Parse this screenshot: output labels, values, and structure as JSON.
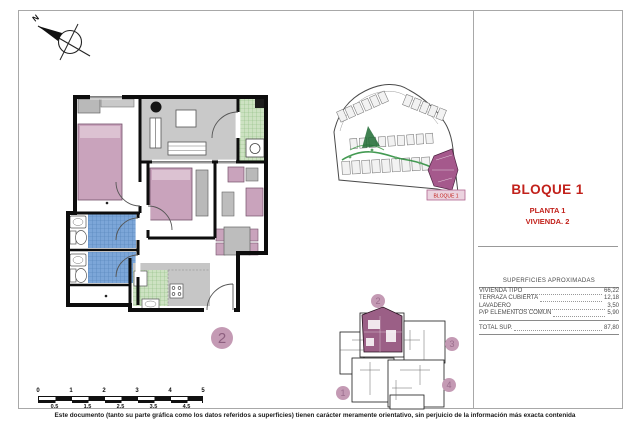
{
  "document": {
    "footer": "Este documento (tanto su parte gráfica como los datos referidos a superficies) tienen carácter meramente orientativo, sin perjuicio de la información más exacta contenida"
  },
  "title_block": {
    "block": "BLOQUE 1",
    "floor": "PLANTA 1",
    "unit": "VIVIENDA. 2"
  },
  "areas_table": {
    "header": "SUPERFICIES APROXIMADAS",
    "rows": [
      {
        "label": "VIVIENDA TIPO",
        "value": "66,22"
      },
      {
        "label": "TERRAZA CUBIERTA",
        "value": "12,18"
      },
      {
        "label": "LAVADERO",
        "value": "3,50"
      },
      {
        "label": "P/P ELEMENTOS COMUN",
        "value": "5,90"
      }
    ],
    "total_label": "TOTAL SUP.",
    "total_value": "87,80"
  },
  "compass": {
    "label": "N"
  },
  "site_plan": {
    "highlight_label": "BLOQUE 1"
  },
  "key_plan": {
    "unit_1": "1",
    "unit_2": "2",
    "unit_3": "3",
    "unit_4": "4"
  },
  "floor_plan": {
    "unit_badge": "2"
  },
  "scale_bar": {
    "top_ticks": [
      "0",
      "1",
      "2",
      "3",
      "4",
      "5"
    ],
    "bottom_ticks": [
      "0.5",
      "1.5",
      "2.5",
      "3.5",
      "4.5"
    ]
  },
  "colors": {
    "accent_red": "#C2211B",
    "furniture_pink": "#C9A3BC",
    "highlight_mauve": "#9B5F86",
    "bath_blue": "#7CA6D8",
    "kitchen_green": "#CDE2C2",
    "terrace_grey": "#C9C9C9",
    "path_green": "#2F8F3F"
  }
}
